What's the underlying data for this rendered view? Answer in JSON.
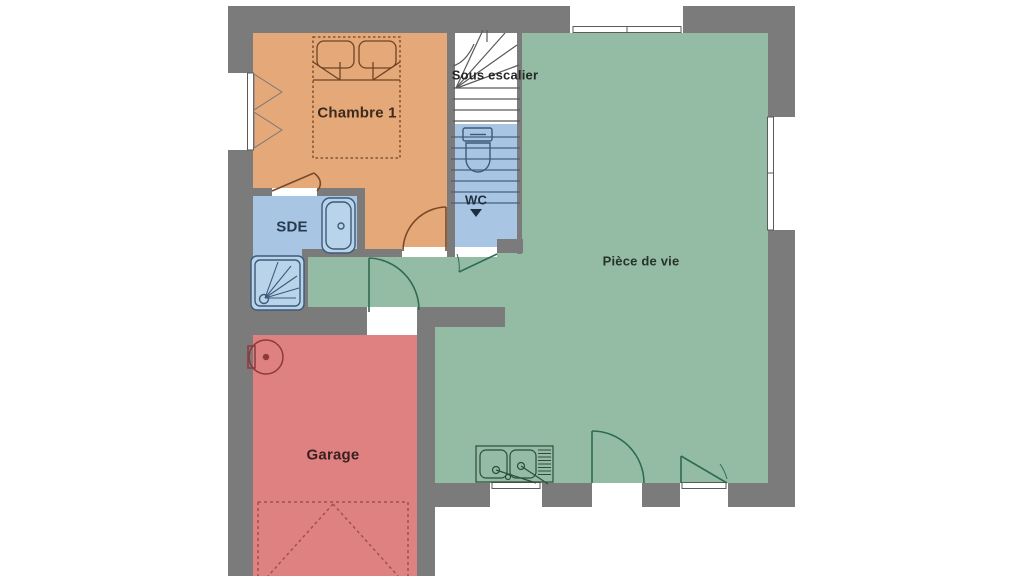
{
  "plan": {
    "rooms": [
      {
        "name": "Chambre 1"
      },
      {
        "name": "SDE"
      },
      {
        "name": "WC"
      },
      {
        "name": "Sous escalier"
      },
      {
        "name": "Pièce de vie"
      },
      {
        "name": "Garage"
      }
    ],
    "colors": {
      "wall": "#7b7b7b",
      "chambre1": "#e5a878",
      "sde": "#a8c6e4",
      "wc": "#a8c6e4",
      "stairs": "#ffffff",
      "piece_de_vie": "#94bca4",
      "garage": "#e08181",
      "fixture_fill": "#b9d3eb"
    },
    "fixtures": [
      "double-bed",
      "bathtub",
      "shower-tray",
      "toilet",
      "staircase",
      "kitchen-sink",
      "water-heater",
      "garage-door",
      "door-arcs",
      "windows"
    ]
  }
}
